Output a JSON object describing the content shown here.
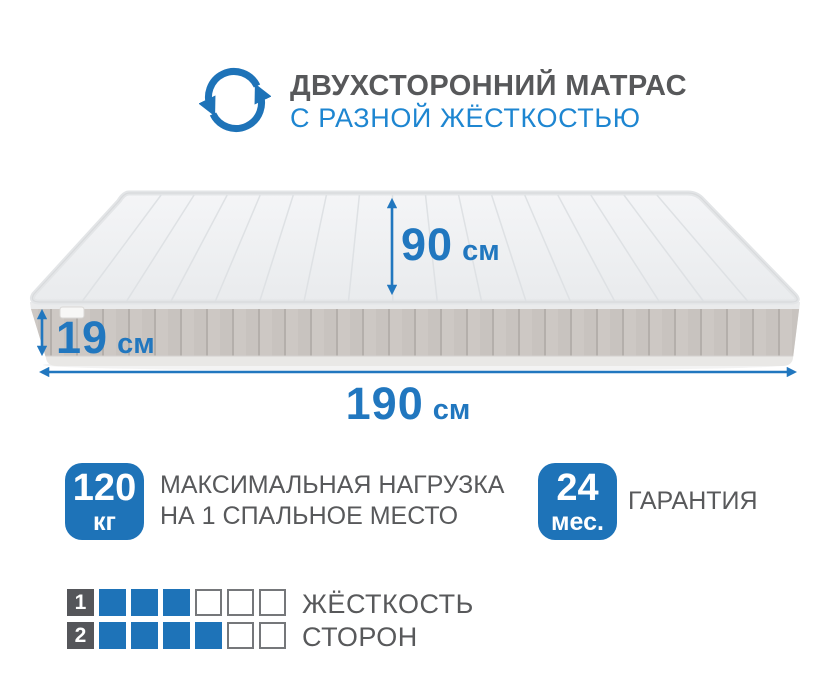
{
  "colors": {
    "accent_blue": "#1e73b8",
    "subtitle_blue": "#1e86d1",
    "arrow_blue": "#2177bf",
    "text_gray": "#58595b",
    "title_gray": "#57585a",
    "cell_dark": "#55565a"
  },
  "header": {
    "icon": "rotate-arrows-icon",
    "title": "ДВУХСТОРОННИЙ МАТРАС",
    "subtitle": "С РАЗНОЙ ЖЁСТКОСТЬЮ"
  },
  "dimensions": {
    "depth": {
      "value": "90",
      "unit": "см"
    },
    "height": {
      "value": "19",
      "unit": "см"
    },
    "length": {
      "value": "190",
      "unit": "см"
    }
  },
  "features": [
    {
      "badge_value": "120",
      "badge_unit": "кг",
      "label_line1": "МАКСИМАЛЬНАЯ НАГРУЗКА",
      "label_line2": "НА 1 СПАЛЬНОЕ МЕСТО"
    },
    {
      "badge_value": "24",
      "badge_unit": "мес.",
      "label_line1": "ГАРАНТИЯ"
    }
  ],
  "hardness": {
    "label_line1": "ЖЁСТКОСТЬ",
    "label_line2": "СТОРОН",
    "scale_max": 6,
    "rows": [
      {
        "side": "1",
        "filled": 3
      },
      {
        "side": "2",
        "filled": 4
      }
    ]
  }
}
